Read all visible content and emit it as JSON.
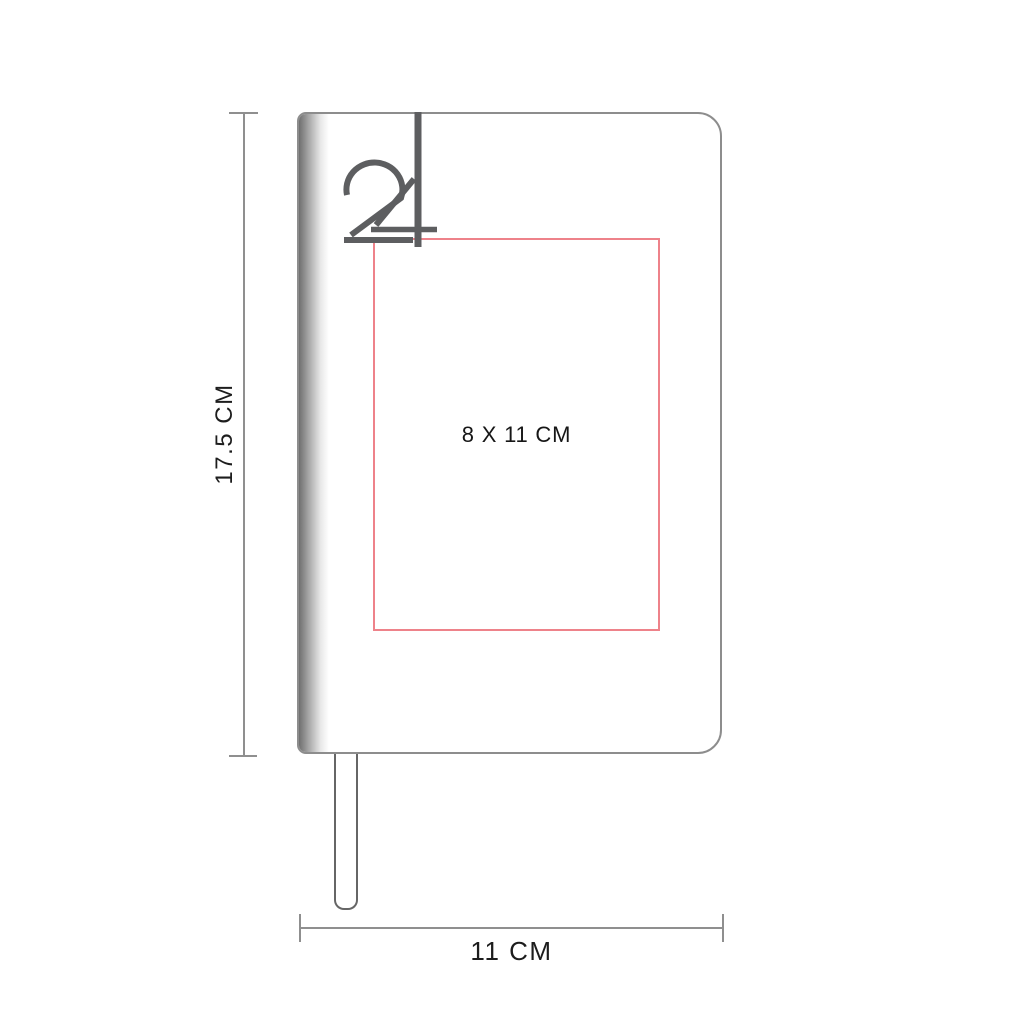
{
  "diagram": {
    "logo": {
      "text": "24",
      "color": "#5d5e60"
    },
    "notebook": {
      "height_label": "17.5 CM",
      "width_label": "11 CM"
    },
    "print_area": {
      "label": "8 X 11 CM",
      "border_color": "#ee828a"
    },
    "colors": {
      "outline_gray": "#8d8d8d",
      "dimension_gray": "#8f8f8f",
      "text_black": "#1d1d1d"
    }
  }
}
